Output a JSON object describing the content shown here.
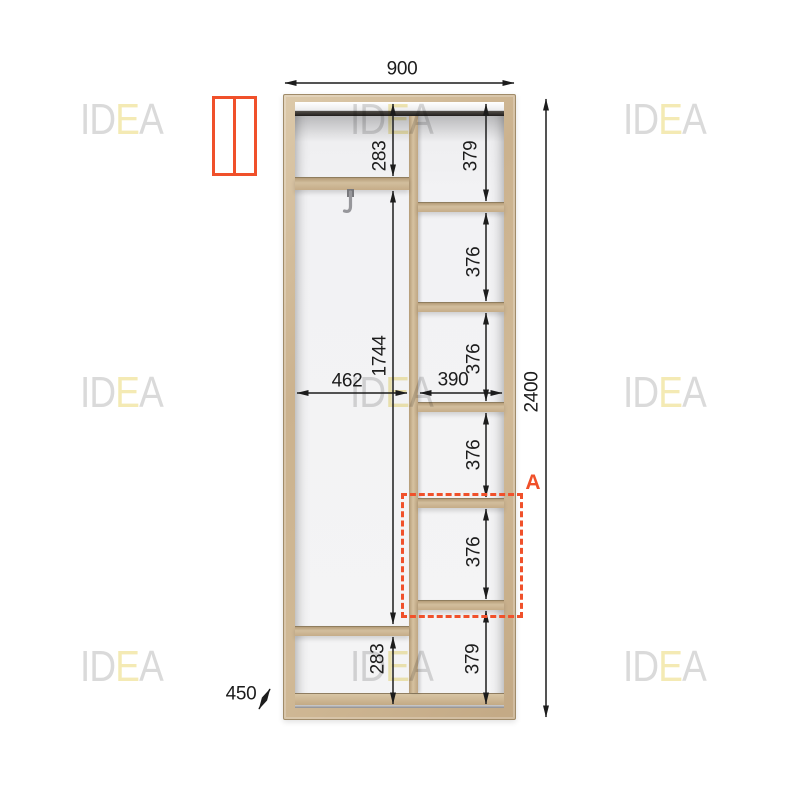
{
  "watermark": {
    "part1": "ID",
    "accent": "E",
    "part2": "A"
  },
  "legend": {
    "door_icon": "two-door-wardrobe-front-view"
  },
  "dims": {
    "top_width": "900",
    "total_height": "2400",
    "depth": "450",
    "left_col_width": "462",
    "right_col_width": "390",
    "left_chain": [
      "283",
      "1744",
      "283"
    ],
    "right_chain": [
      "379",
      "376",
      "376",
      "376",
      "376",
      "379"
    ],
    "section_label": "A"
  },
  "colors": {
    "accent_orange": "#F0502A",
    "wood": "#CDB493",
    "dim_line": "#1C1C1C",
    "watermark_gray": "#D7D7D7",
    "watermark_yellow": "#F3E9AE"
  }
}
